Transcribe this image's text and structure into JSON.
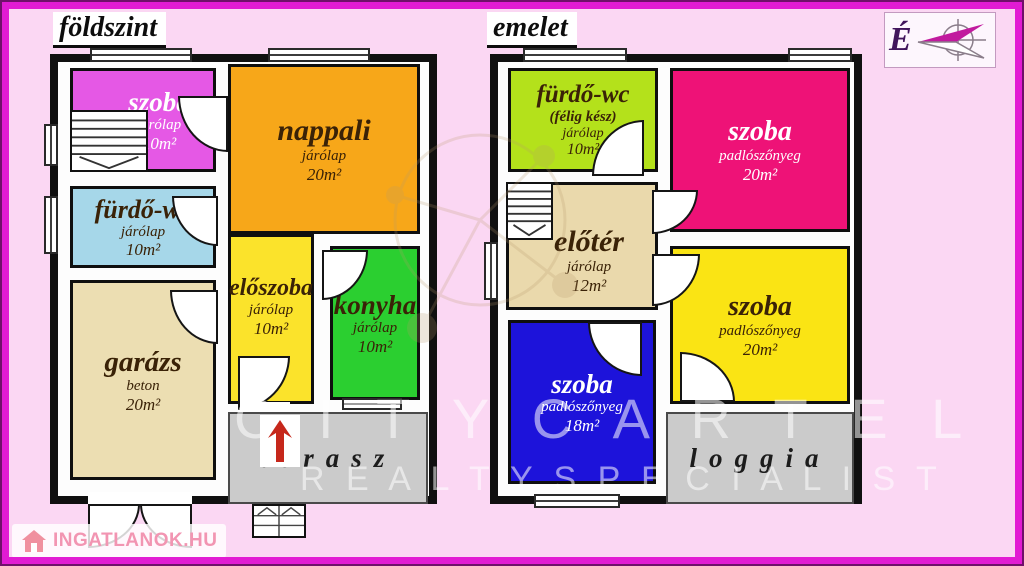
{
  "compass": {
    "label": "É"
  },
  "brand": {
    "logo_text": "INGATLANOK.HU"
  },
  "watermarks": {
    "band_top": "C I T Y   C A R T E L",
    "band_bottom": "R E A L T Y   S P E C I A L I S T"
  },
  "colors": {
    "background": "#fbd7f3",
    "frame": "#e21bd3",
    "wall": "#101010",
    "ground": {
      "szoba": "#e558e5",
      "nappali": "#f7a719",
      "furdo_wc": "#a6d7e9",
      "garazs": "#ecdeb2",
      "eloszoba": "#fbe32b",
      "konyha": "#2bcf30",
      "terasz": "#cbcbcb"
    },
    "upper": {
      "furdo_wc": "#b4e11b",
      "szoba_top": "#ee1277",
      "eloter": "#ead9ac",
      "szoba_mid": "#fae414",
      "szoba_bottom": "#1d13da",
      "loggia": "#cbcbcb"
    }
  },
  "floors": {
    "ground": {
      "title": "földszint",
      "rooms": {
        "szoba": {
          "name": "szoba",
          "floor": "járólap",
          "area": "10m²"
        },
        "nappali": {
          "name": "nappali",
          "floor": "járólap",
          "area": "20m²"
        },
        "furdo_wc": {
          "name": "fürdő-wc",
          "floor": "járólap",
          "area": "10m²"
        },
        "garazs": {
          "name": "garázs",
          "floor": "beton",
          "area": "20m²"
        },
        "eloszoba": {
          "name": "előszoba",
          "floor": "járólap",
          "area": "10m²"
        },
        "konyha": {
          "name": "konyha",
          "floor": "járólap",
          "area": "10m²"
        },
        "terasz": {
          "name": "terasz"
        }
      }
    },
    "upper": {
      "title": "emelet",
      "rooms": {
        "furdo_wc": {
          "name": "fürdő-wc",
          "status": "(félig kész)",
          "floor": "járólap",
          "area": "10m²"
        },
        "szoba_top": {
          "name": "szoba",
          "floor": "padlószőnyeg",
          "area": "20m²"
        },
        "eloter": {
          "name": "előtér",
          "floor": "járólap",
          "area": "12m²"
        },
        "szoba_mid": {
          "name": "szoba",
          "floor": "padlószőnyeg",
          "area": "20m²"
        },
        "szoba_bottom": {
          "name": "szoba",
          "floor": "padlószőnyeg",
          "area": "18m²"
        },
        "loggia": {
          "name": "loggia"
        }
      }
    }
  }
}
